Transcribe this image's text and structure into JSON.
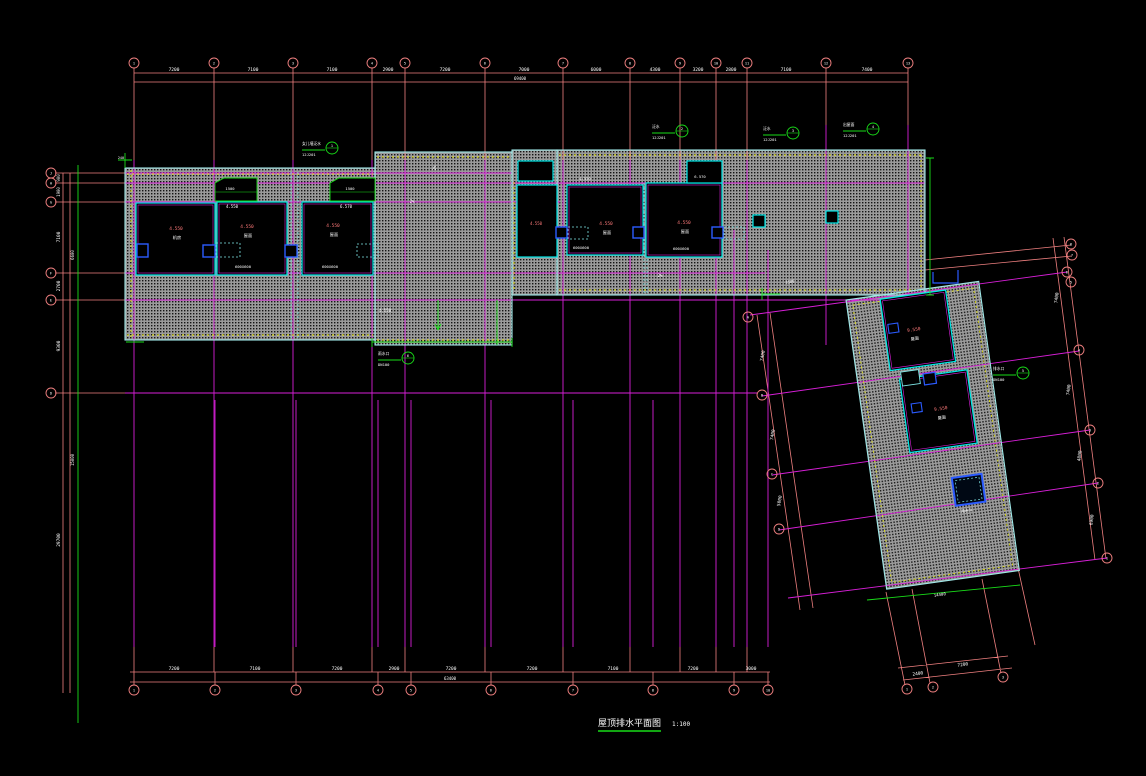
{
  "title": {
    "text": "屋顶排水平面图",
    "scale": "1:100"
  },
  "colors": {
    "w": "#ffffff",
    "r": "#ff7a7a",
    "g": "#19dd19",
    "m": "#d81fd8",
    "s": "#f08080",
    "c": "#00e8e8",
    "y": "#e8e800",
    "b": "#2b5bff"
  },
  "axes": {
    "top": {
      "r": 5,
      "items": [
        [
          134,
          63,
          "1"
        ],
        [
          214,
          63,
          "2"
        ],
        [
          293,
          63,
          "3"
        ],
        [
          372,
          63,
          "4"
        ],
        [
          405,
          63,
          "5"
        ],
        [
          485,
          63,
          "6"
        ],
        [
          563,
          63,
          "7"
        ],
        [
          630,
          63,
          "8"
        ],
        [
          680,
          63,
          "9"
        ],
        [
          716,
          63,
          "10"
        ],
        [
          747,
          63,
          "11"
        ],
        [
          826,
          63,
          "12"
        ],
        [
          908,
          63,
          "13"
        ]
      ]
    },
    "bottom": {
      "r": 5,
      "items": [
        [
          134,
          690,
          "1"
        ],
        [
          215,
          690,
          "2"
        ],
        [
          296,
          690,
          "3"
        ],
        [
          378,
          690,
          "4"
        ],
        [
          411,
          690,
          "5"
        ],
        [
          491,
          690,
          "6"
        ],
        [
          573,
          690,
          "7"
        ],
        [
          653,
          690,
          "8"
        ],
        [
          734,
          690,
          "9"
        ],
        [
          768,
          690,
          "10"
        ]
      ]
    },
    "left": {
      "r": 5,
      "items": [
        [
          51,
          173,
          "J"
        ],
        [
          51,
          183,
          "H"
        ],
        [
          51,
          202,
          "G"
        ],
        [
          51,
          273,
          "F"
        ],
        [
          51,
          300,
          "E"
        ],
        [
          51,
          393,
          "D"
        ]
      ]
    },
    "rot_right": {
      "r": 5,
      "items": [
        [
          1071,
          244,
          "8"
        ],
        [
          1072,
          255,
          "7"
        ],
        [
          1067,
          272,
          "6"
        ],
        [
          1071,
          282,
          "5"
        ],
        [
          1079,
          350,
          "4"
        ],
        [
          1090,
          430,
          "3"
        ],
        [
          1098,
          483,
          "2"
        ],
        [
          1107,
          558,
          "1"
        ]
      ]
    },
    "rot_left": {
      "r": 5,
      "items": [
        [
          748,
          317,
          "A"
        ],
        [
          762,
          395,
          "B"
        ],
        [
          772,
          474,
          "C"
        ],
        [
          779,
          529,
          "D"
        ]
      ]
    },
    "rot_bottom": {
      "r": 5,
      "items": [
        [
          907,
          689,
          "1"
        ],
        [
          933,
          687,
          "2"
        ],
        [
          1003,
          677,
          "3"
        ]
      ]
    }
  },
  "annotations": [
    [
      "7200",
      174,
      71
    ],
    [
      "7100",
      253,
      71
    ],
    [
      "7100",
      332,
      71
    ],
    [
      "2900",
      388,
      71
    ],
    [
      "7200",
      445,
      71
    ],
    [
      "7000",
      524,
      71
    ],
    [
      "6000",
      596,
      71
    ],
    [
      "4300",
      655,
      71
    ],
    [
      "3200",
      698,
      71
    ],
    [
      "2800",
      731,
      71
    ],
    [
      "7100",
      786,
      71
    ],
    [
      "7400",
      867,
      71
    ],
    [
      "69400",
      520,
      80,
      "w",
      4
    ],
    [
      "7200",
      174,
      670
    ],
    [
      "7100",
      255,
      670
    ],
    [
      "7200",
      337,
      670
    ],
    [
      "2900",
      394,
      670
    ],
    [
      "7200",
      451,
      670
    ],
    [
      "7200",
      532,
      670
    ],
    [
      "7100",
      613,
      670
    ],
    [
      "7200",
      693,
      670
    ],
    [
      "3000",
      751,
      670
    ],
    [
      "63400",
      450,
      680,
      "w",
      4
    ],
    [
      "900",
      60,
      178,
      "w",
      4,
      -90
    ],
    [
      "1900",
      60,
      192,
      "w",
      4,
      -90
    ],
    [
      "7100",
      60,
      237,
      "w",
      4.5,
      -90
    ],
    [
      "2700",
      60,
      286,
      "w",
      4.5,
      -90
    ],
    [
      "9300",
      60,
      346,
      "w",
      4.5,
      -90
    ],
    [
      "29700",
      60,
      540,
      "w",
      4.5,
      -90
    ],
    [
      "6600",
      74,
      255,
      "w",
      4,
      -90
    ],
    [
      "15000",
      74,
      460,
      "w",
      4,
      -90
    ],
    [
      "7400",
      1058,
      298,
      "w",
      4.5,
      -83
    ],
    [
      "7400",
      1070,
      390,
      "w",
      4.5,
      -83
    ],
    [
      "4800",
      1081,
      456,
      "w",
      4.5,
      -83
    ],
    [
      "6900",
      1093,
      520,
      "w",
      4.5,
      -83
    ],
    [
      "7400",
      764,
      356,
      "w",
      4.5,
      -80
    ],
    [
      "7400",
      774,
      435,
      "w",
      4.5,
      -80
    ],
    [
      "5000",
      781,
      501,
      "w",
      4.5,
      -80
    ],
    [
      "2400",
      918,
      675,
      "w",
      4.5,
      -8
    ],
    [
      "7200",
      963,
      666,
      "w",
      4.5,
      -8
    ],
    [
      "14400",
      940,
      596,
      "w",
      4,
      -8
    ],
    [
      "1500",
      230,
      190,
      "w",
      3.8
    ],
    [
      "1500",
      350,
      190,
      "w",
      3.8
    ],
    [
      "4.550",
      232,
      208,
      "w",
      4
    ],
    [
      "6.570",
      346,
      208,
      "w",
      4
    ],
    [
      "4.550",
      176,
      230,
      "r",
      4.5
    ],
    [
      "机房",
      177,
      239,
      "w",
      4.2
    ],
    [
      "4.550",
      247,
      228,
      "r",
      4.5
    ],
    [
      "屋面",
      248,
      237,
      "w",
      4.2
    ],
    [
      "600X600",
      243,
      268,
      "w",
      3.8
    ],
    [
      "4.550",
      333,
      227,
      "r",
      4.5
    ],
    [
      "屋面",
      334,
      236,
      "w",
      4.2
    ],
    [
      "600X600",
      330,
      268,
      "w",
      3.8
    ],
    [
      "4.550",
      606,
      225,
      "r",
      4.5
    ],
    [
      "屋面",
      607,
      234,
      "w",
      4.2
    ],
    [
      "600X600",
      581,
      249,
      "w",
      3.8
    ],
    [
      "4.550",
      585,
      180,
      "w",
      3.8
    ],
    [
      "4.550",
      684,
      224,
      "r",
      4.5
    ],
    [
      "屋面",
      685,
      233,
      "w",
      4.2
    ],
    [
      "600X600",
      681,
      250,
      "w",
      3.8
    ],
    [
      "6.570",
      700,
      178,
      "w",
      3.8
    ],
    [
      "4.550",
      536,
      225,
      "r",
      4
    ],
    [
      "9.550",
      914,
      331,
      "r",
      4.5,
      -8
    ],
    [
      "屋面",
      915,
      340,
      "w",
      4.2,
      -8
    ],
    [
      "9.550",
      941,
      410,
      "r",
      4.5,
      -8
    ],
    [
      "屋面",
      942,
      419,
      "w",
      4.2,
      -8
    ],
    [
      "雨水斗",
      967,
      512,
      "w",
      3.8,
      -8
    ],
    [
      "2%",
      436,
      168,
      "w",
      4,
      -90
    ],
    [
      "4.550",
      385,
      312,
      "w",
      4
    ],
    [
      "2%",
      660,
      277,
      "w",
      4
    ],
    [
      "2%",
      412,
      203,
      "w",
      4
    ],
    [
      "1500",
      790,
      283,
      "w",
      3.8,
      -8
    ],
    [
      "240",
      121,
      159,
      "w",
      3.5
    ]
  ],
  "callouts": [
    {
      "cx": 332,
      "cy": 148,
      "num": "1",
      "t1": "女儿墙泛水",
      "t2": "12J201"
    },
    {
      "cx": 682,
      "cy": 131,
      "num": "2",
      "t1": "泛水",
      "t2": "12J201"
    },
    {
      "cx": 793,
      "cy": 133,
      "num": "3",
      "t1": "泛水",
      "t2": "12J201"
    },
    {
      "cx": 873,
      "cy": 129,
      "num": "4",
      "t1": "出屋面",
      "t2": "12J201"
    },
    {
      "cx": 1023,
      "cy": 373,
      "num": "5",
      "t1": "排水口",
      "t2": "DN100"
    },
    {
      "cx": 408,
      "cy": 358,
      "num": "6",
      "t1": "雨水口",
      "t2": "DN100"
    }
  ]
}
